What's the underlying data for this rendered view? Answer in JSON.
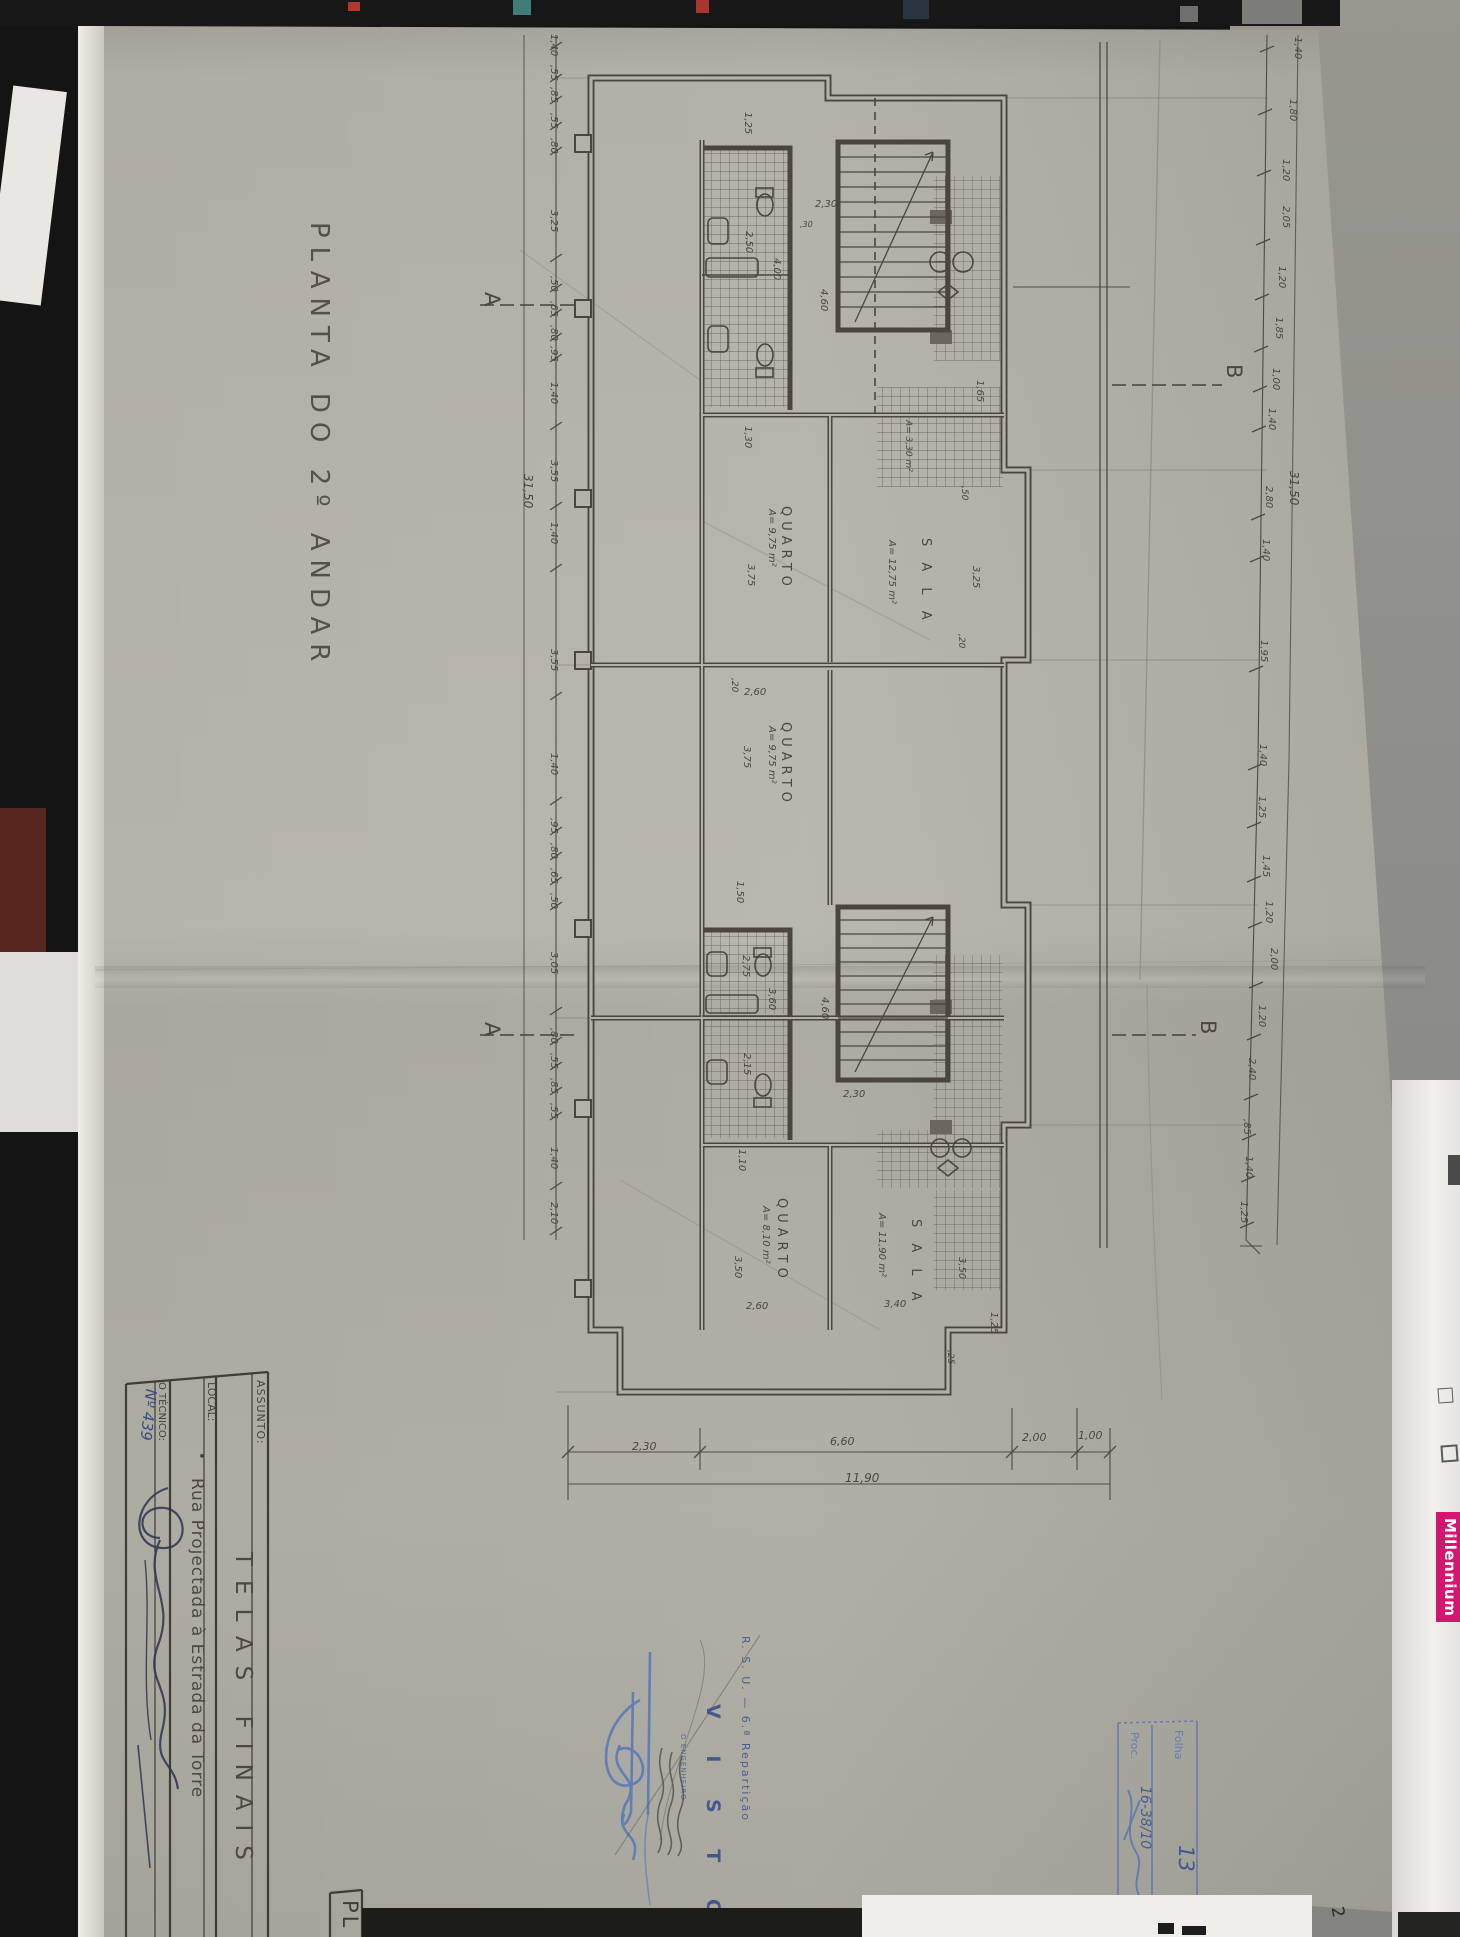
{
  "sheet": {
    "title": "PLANTA  DO  2º  ANDAR",
    "section_marker_a": "A",
    "section_marker_b": "B"
  },
  "title_block": {
    "assunto_label": "ASSUNTO:",
    "assunto_value": "TELAS  FINAIS",
    "local_label": "LOCAL:",
    "local_bullet": "•",
    "local_value": "Rua  Projectada  à  Estrada  da  Torre",
    "tecnico_label": "O TÉCNICO:",
    "tecnico_number": "Nº 439",
    "corner_code": "PL"
  },
  "stamps": {
    "visto_org": "R. S. U. — 6.ª Repartição",
    "visto_word": "V I S T O",
    "visto_sub": "O ENGENHEIRO",
    "folha_label": "Folha",
    "folha_value": "13",
    "proc_label": "Proc.",
    "proc_value": "16-38/10"
  },
  "side_strip": {
    "brand": "Millennium",
    "page_number": "2"
  },
  "rooms": [
    {
      "t": "QUARTO",
      "x": 792,
      "y": 506,
      "k": 13,
      "ls": 5
    },
    {
      "t": "A= 9,75 m²",
      "x": 776,
      "y": 509,
      "k": 10,
      "i": 1
    },
    {
      "t": "QUARTO",
      "x": 792,
      "y": 722,
      "k": 13,
      "ls": 5
    },
    {
      "t": "A= 9,75 m²",
      "x": 776,
      "y": 726,
      "k": 10,
      "i": 1
    },
    {
      "t": "S A L A",
      "x": 932,
      "y": 538,
      "k": 13,
      "ls": 6
    },
    {
      "t": "A= 12,75 m²",
      "x": 896,
      "y": 540,
      "k": 10,
      "i": 1
    },
    {
      "t": "QUARTO",
      "x": 788,
      "y": 1198,
      "k": 13,
      "ls": 5
    },
    {
      "t": "A= 8,10 m²",
      "x": 770,
      "y": 1206,
      "k": 10,
      "i": 1
    },
    {
      "t": "S A L A",
      "x": 922,
      "y": 1219,
      "k": 13,
      "ls": 6
    },
    {
      "t": "A= 11,90 m²",
      "x": 886,
      "y": 1213,
      "k": 10,
      "i": 1
    },
    {
      "t": "A= 3,30 m²",
      "x": 912,
      "y": 420,
      "k": 9,
      "i": 1
    }
  ],
  "plan_dims": [
    {
      "t": "1,25",
      "x": 752,
      "y": 112,
      "k": 10
    },
    {
      "t": "2,50",
      "x": 753,
      "y": 231,
      "k": 10
    },
    {
      "t": "4,00",
      "x": 781,
      "y": 258,
      "k": 10
    },
    {
      "t": "4,60",
      "x": 828,
      "y": 289,
      "k": 10
    },
    {
      "t": "1,30",
      "x": 752,
      "y": 426,
      "k": 10
    },
    {
      "t": "3,75",
      "x": 755,
      "y": 564,
      "k": 10
    },
    {
      "t": ",20",
      "x": 738,
      "y": 678,
      "k": 9
    },
    {
      "t": "3,75",
      "x": 751,
      "y": 746,
      "k": 10
    },
    {
      "t": "1,65",
      "x": 984,
      "y": 380,
      "k": 10
    },
    {
      "t": ",50",
      "x": 968,
      "y": 486,
      "k": 9
    },
    {
      "t": "3,25",
      "x": 980,
      "y": 566,
      "k": 10
    },
    {
      "t": ",20",
      "x": 965,
      "y": 634,
      "k": 9
    },
    {
      "t": "1,50",
      "x": 744,
      "y": 881,
      "k": 10
    },
    {
      "t": "2,75",
      "x": 750,
      "y": 955,
      "k": 10
    },
    {
      "t": "3,60",
      "x": 776,
      "y": 988,
      "k": 10
    },
    {
      "t": "2,15",
      "x": 751,
      "y": 1053,
      "k": 10
    },
    {
      "t": "4,60",
      "x": 829,
      "y": 997,
      "k": 10
    },
    {
      "t": "1,10",
      "x": 746,
      "y": 1149,
      "k": 10
    },
    {
      "t": "3,50",
      "x": 742,
      "y": 1256,
      "k": 10
    },
    {
      "t": "3,50",
      "x": 966,
      "y": 1257,
      "k": 10
    },
    {
      "t": "1,25",
      "x": 998,
      "y": 1312,
      "k": 10
    },
    {
      "t": ",25",
      "x": 954,
      "y": 1350,
      "k": 9
    },
    {
      "t": "2,30",
      "x": 815,
      "y": 200,
      "k": 10,
      "h": 1
    },
    {
      "t": ",30",
      "x": 800,
      "y": 221,
      "k": 8,
      "h": 1
    },
    {
      "t": "2,60",
      "x": 744,
      "y": 688,
      "k": 10,
      "h": 1
    },
    {
      "t": "2,60",
      "x": 746,
      "y": 1302,
      "k": 10,
      "h": 1
    },
    {
      "t": "3,40",
      "x": 884,
      "y": 1300,
      "k": 10,
      "h": 1
    },
    {
      "t": "2,30",
      "x": 843,
      "y": 1090,
      "k": 10,
      "h": 1
    }
  ],
  "chain_left": {
    "x": 558,
    "items": [
      {
        "t": "1,40",
        "y": 34
      },
      {
        "t": ",55",
        "y": 65
      },
      {
        "t": ",85",
        "y": 87
      },
      {
        "t": ",55",
        "y": 113
      },
      {
        "t": ",80",
        "y": 138
      },
      {
        "t": "3,25",
        "y": 210
      },
      {
        "t": ",50",
        "y": 276
      },
      {
        "t": ",65",
        "y": 301
      },
      {
        "t": ",80",
        "y": 325
      },
      {
        "t": ",95",
        "y": 346
      },
      {
        "t": "1,40",
        "y": 382
      },
      {
        "t": "3,55",
        "y": 460
      },
      {
        "t": "1,40",
        "y": 522
      },
      {
        "t": "3,55",
        "y": 649
      },
      {
        "t": "1,40",
        "y": 753
      },
      {
        "t": ",95",
        "y": 818
      },
      {
        "t": ",80",
        "y": 843
      },
      {
        "t": ",65",
        "y": 868
      },
      {
        "t": ",50",
        "y": 893
      },
      {
        "t": "3,05",
        "y": 952
      },
      {
        "t": ",80",
        "y": 1028
      },
      {
        "t": ",55",
        "y": 1053
      },
      {
        "t": ",85",
        "y": 1078
      },
      {
        "t": ",55",
        "y": 1103
      },
      {
        "t": "1,40",
        "y": 1147
      },
      {
        "t": "2,10",
        "y": 1202
      }
    ],
    "total": {
      "t": "31,50",
      "x": 534,
      "y": 474
    }
  },
  "chain_right": {
    "items": [
      {
        "t": "1,40",
        "x": 1302,
        "y": 37
      },
      {
        "t": "1,80",
        "x": 1297,
        "y": 99
      },
      {
        "t": "1,20",
        "x": 1290,
        "y": 159
      },
      {
        "t": "2,05",
        "x": 1290,
        "y": 206
      },
      {
        "t": "1,20",
        "x": 1286,
        "y": 266
      },
      {
        "t": "1,85",
        "x": 1283,
        "y": 317
      },
      {
        "t": "1,00",
        "x": 1280,
        "y": 368
      },
      {
        "t": "1,40",
        "x": 1276,
        "y": 408
      },
      {
        "t": "2,80",
        "x": 1273,
        "y": 486
      },
      {
        "t": "1,40",
        "x": 1270,
        "y": 539
      },
      {
        "t": "1,95",
        "x": 1268,
        "y": 640
      },
      {
        "t": "1,40",
        "x": 1267,
        "y": 744
      },
      {
        "t": "1,25",
        "x": 1266,
        "y": 796
      },
      {
        "t": "1,45",
        "x": 1270,
        "y": 855
      },
      {
        "t": "1,20",
        "x": 1273,
        "y": 901
      },
      {
        "t": "2,00",
        "x": 1278,
        "y": 948
      },
      {
        "t": "1,20",
        "x": 1266,
        "y": 1005
      },
      {
        "t": "2,40",
        "x": 1256,
        "y": 1058
      },
      {
        "t": ",85",
        "x": 1251,
        "y": 1119
      },
      {
        "t": "1,40",
        "x": 1253,
        "y": 1156
      },
      {
        "t": "1,25",
        "x": 1248,
        "y": 1201
      }
    ],
    "total": {
      "t": "31,50",
      "x": 1300,
      "y": 471
    }
  },
  "chain_bottom": {
    "items": [
      {
        "t": "2,30",
        "x": 632,
        "y": 1441
      },
      {
        "t": "6,60",
        "x": 830,
        "y": 1436
      },
      {
        "t": "2,00",
        "x": 1022,
        "y": 1432
      },
      {
        "t": "1,00",
        "x": 1078,
        "y": 1430
      }
    ],
    "total": {
      "t": "11,90",
      "x": 845,
      "y": 1472
    }
  },
  "markers": [
    {
      "t": "A",
      "x": 502,
      "y": 292
    },
    {
      "t": "A",
      "x": 502,
      "y": 1022
    },
    {
      "t": "B",
      "x": 1244,
      "y": 364
    },
    {
      "t": "B",
      "x": 1218,
      "y": 1020
    }
  ]
}
